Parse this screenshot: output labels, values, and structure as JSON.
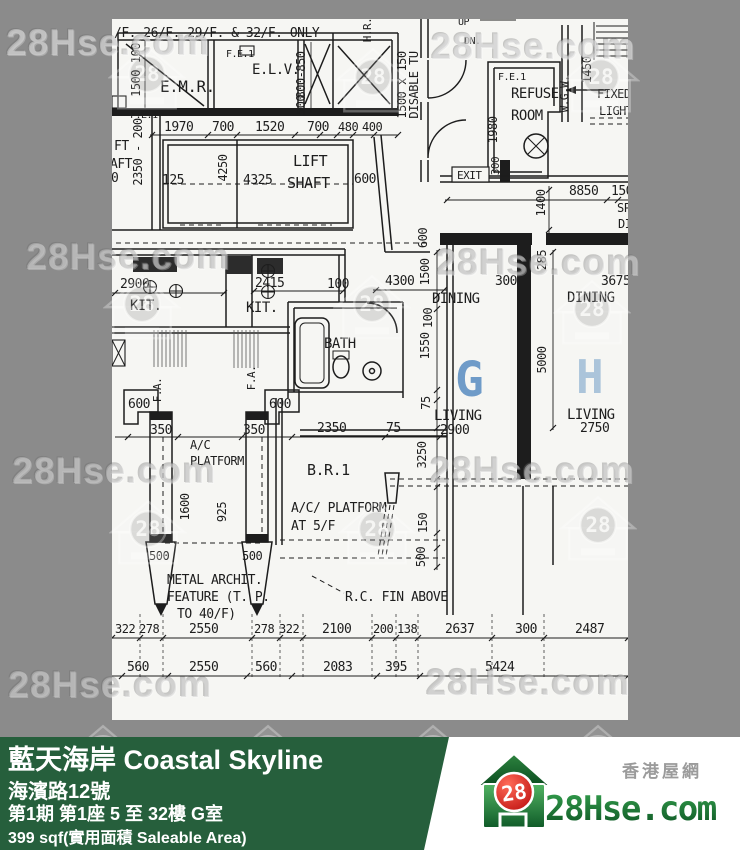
{
  "colors": {
    "page_bg": "#8b8b8b",
    "paper": "#f6f6f3",
    "ink": "#1d1d1d",
    "footer_green": "#265f3c",
    "brand_green_dark": "#0d5524",
    "brand_green_light": "#3fa351",
    "brand_red": "#c40f0f",
    "unit_g_color": "#6f9bc8",
    "unit_h_color": "#abc4da"
  },
  "watermark": {
    "text": "28Hse.com",
    "logo_number": "28"
  },
  "footer": {
    "title": "藍天海岸 Coastal Skyline",
    "address": "海濱路12號",
    "unit_info": "第1期 第1座 5 至 32樓 G室",
    "area": "399 sqf(實用面積 Saleable Area)"
  },
  "brand": {
    "site_cn": "香港屋網",
    "site_name": "28Hse.com",
    "logo_number": "28"
  },
  "plan": {
    "labels": [
      {
        "t": "/F. 26/F. 29/F. & 32/F. ONLY",
        "x": 114,
        "y": 37,
        "s": 13
      },
      {
        "t": "E.M.R.",
        "x": 160,
        "y": 92,
        "s": 16
      },
      {
        "t": "F.E.1",
        "x": 130,
        "y": 118,
        "s": 10
      },
      {
        "t": "F.E.1",
        "x": 226,
        "y": 57,
        "s": 10
      },
      {
        "t": "E.L.V.",
        "x": 252,
        "y": 74,
        "s": 14
      },
      {
        "t": "UP",
        "x": 458,
        "y": 25,
        "s": 10
      },
      {
        "t": "DN.",
        "x": 464,
        "y": 44,
        "s": 10
      },
      {
        "t": "F.E.1",
        "x": 498,
        "y": 80,
        "s": 10
      },
      {
        "t": "REFUSE",
        "x": 511,
        "y": 98,
        "s": 14
      },
      {
        "t": "ROOM",
        "x": 511,
        "y": 120,
        "s": 14
      },
      {
        "t": "FIXED",
        "x": 597,
        "y": 98,
        "s": 12
      },
      {
        "t": "LIGHT",
        "x": 599,
        "y": 115,
        "s": 12
      },
      {
        "t": "EXIT",
        "x": 457,
        "y": 179,
        "s": 11
      },
      {
        "t": "8850",
        "x": 569,
        "y": 195,
        "s": 13
      },
      {
        "t": "150",
        "x": 611,
        "y": 195,
        "s": 13
      },
      {
        "t": "SP",
        "x": 617,
        "y": 212,
        "s": 12
      },
      {
        "t": "DI",
        "x": 618,
        "y": 228,
        "s": 12
      },
      {
        "t": "FT",
        "x": 114,
        "y": 150,
        "s": 13
      },
      {
        "t": "AFT",
        "x": 110,
        "y": 168,
        "s": 13
      },
      {
        "t": "0",
        "x": 111,
        "y": 182,
        "s": 13
      },
      {
        "t": "1970",
        "x": 164,
        "y": 131,
        "s": 13
      },
      {
        "t": "700",
        "x": 212,
        "y": 131,
        "s": 13
      },
      {
        "t": "1520",
        "x": 255,
        "y": 131,
        "s": 13
      },
      {
        "t": "700",
        "x": 307,
        "y": 131,
        "s": 13
      },
      {
        "t": "480",
        "x": 338,
        "y": 131,
        "s": 12
      },
      {
        "t": "400",
        "x": 362,
        "y": 131,
        "s": 12
      },
      {
        "t": "LIFT",
        "x": 293,
        "y": 166,
        "s": 15
      },
      {
        "t": "SHAFT",
        "x": 287,
        "y": 188,
        "s": 15
      },
      {
        "t": "125",
        "x": 162,
        "y": 184,
        "s": 13
      },
      {
        "t": "4325",
        "x": 243,
        "y": 184,
        "s": 13
      },
      {
        "t": "600",
        "x": 354,
        "y": 183,
        "s": 13
      },
      {
        "t": "2900",
        "x": 120,
        "y": 288,
        "s": 13
      },
      {
        "t": "KIT.",
        "x": 130,
        "y": 310,
        "s": 14
      },
      {
        "t": "2415",
        "x": 255,
        "y": 287,
        "s": 13
      },
      {
        "t": "KIT.",
        "x": 246,
        "y": 312,
        "s": 14
      },
      {
        "t": "100",
        "x": 327,
        "y": 288,
        "s": 13
      },
      {
        "t": "BATH",
        "x": 324,
        "y": 348,
        "s": 14
      },
      {
        "t": "600",
        "x": 128,
        "y": 408,
        "s": 13
      },
      {
        "t": "600",
        "x": 269,
        "y": 408,
        "s": 13
      },
      {
        "t": "350",
        "x": 150,
        "y": 434,
        "s": 13
      },
      {
        "t": "350",
        "x": 243,
        "y": 434,
        "s": 13
      },
      {
        "t": "2350",
        "x": 317,
        "y": 432,
        "s": 13
      },
      {
        "t": "75",
        "x": 386,
        "y": 432,
        "s": 13
      },
      {
        "t": "A/C",
        "x": 190,
        "y": 449,
        "s": 12
      },
      {
        "t": "PLATFORM",
        "x": 190,
        "y": 465,
        "s": 12
      },
      {
        "t": "B.R.1",
        "x": 307,
        "y": 475,
        "s": 15
      },
      {
        "t": "A/C/ PLATFORM",
        "x": 291,
        "y": 512,
        "s": 13
      },
      {
        "t": "AT 5/F",
        "x": 291,
        "y": 530,
        "s": 13
      },
      {
        "t": "500",
        "x": 149,
        "y": 560,
        "s": 12
      },
      {
        "t": "500",
        "x": 242,
        "y": 560,
        "s": 12
      },
      {
        "t": "METAL ARCHIT.",
        "x": 167,
        "y": 584,
        "s": 13
      },
      {
        "t": "FEATURE (T. P.",
        "x": 167,
        "y": 601,
        "s": 13
      },
      {
        "t": "TO 40/F)",
        "x": 177,
        "y": 618,
        "s": 13
      },
      {
        "t": "R.C. FIN ABOVE",
        "x": 345,
        "y": 601,
        "s": 13
      },
      {
        "t": "4300",
        "x": 385,
        "y": 285,
        "s": 13
      },
      {
        "t": "300",
        "x": 495,
        "y": 285,
        "s": 13
      },
      {
        "t": "3675",
        "x": 601,
        "y": 285,
        "s": 13
      },
      {
        "t": "DINING",
        "x": 432,
        "y": 303,
        "s": 14
      },
      {
        "t": "DINING",
        "x": 567,
        "y": 302,
        "s": 14
      },
      {
        "t": "G",
        "x": 455,
        "y": 396,
        "s": 48,
        "c": "#6f9bc8",
        "b": 1
      },
      {
        "t": "H",
        "x": 576,
        "y": 393,
        "s": 46,
        "c": "#abc4da",
        "b": 1
      },
      {
        "t": "LIVING",
        "x": 434,
        "y": 420,
        "s": 14
      },
      {
        "t": "2900",
        "x": 440,
        "y": 434,
        "s": 13
      },
      {
        "t": "LIVING",
        "x": 567,
        "y": 419,
        "s": 14
      },
      {
        "t": "2750",
        "x": 580,
        "y": 432,
        "s": 13
      },
      {
        "t": "322",
        "x": 115,
        "y": 633,
        "s": 12
      },
      {
        "t": "278",
        "x": 139,
        "y": 633,
        "s": 12
      },
      {
        "t": "2550",
        "x": 189,
        "y": 633,
        "s": 13
      },
      {
        "t": "278",
        "x": 254,
        "y": 633,
        "s": 12
      },
      {
        "t": "322",
        "x": 279,
        "y": 633,
        "s": 12
      },
      {
        "t": "2100",
        "x": 322,
        "y": 633,
        "s": 13
      },
      {
        "t": "200",
        "x": 373,
        "y": 633,
        "s": 12
      },
      {
        "t": "138",
        "x": 397,
        "y": 633,
        "s": 12
      },
      {
        "t": "2637",
        "x": 445,
        "y": 633,
        "s": 13
      },
      {
        "t": "300",
        "x": 515,
        "y": 633,
        "s": 13
      },
      {
        "t": "2487",
        "x": 575,
        "y": 633,
        "s": 13
      },
      {
        "t": "560",
        "x": 127,
        "y": 671,
        "s": 13
      },
      {
        "t": "2550",
        "x": 189,
        "y": 671,
        "s": 13
      },
      {
        "t": "560",
        "x": 255,
        "y": 671,
        "s": 13
      },
      {
        "t": "2083",
        "x": 323,
        "y": 671,
        "s": 13
      },
      {
        "t": "395",
        "x": 385,
        "y": 671,
        "s": 13
      },
      {
        "t": "5424",
        "x": 485,
        "y": 671,
        "s": 13
      },
      {
        "t": "1500 100",
        "x": 140,
        "y": 70,
        "s": 12,
        "v": 1
      },
      {
        "t": "2350 - 200",
        "x": 142,
        "y": 152,
        "s": 12,
        "v": 1
      },
      {
        "t": "800-850",
        "x": 305,
        "y": 75,
        "s": 12,
        "v": 1
      },
      {
        "t": "500",
        "x": 305,
        "y": 105,
        "s": 12,
        "v": 1
      },
      {
        "t": "H.R.",
        "x": 371,
        "y": 30,
        "s": 11,
        "v": 1
      },
      {
        "t": "1500 x 150",
        "x": 406,
        "y": 85,
        "s": 12,
        "v": 1
      },
      {
        "t": "DISABLE TU",
        "x": 418,
        "y": 85,
        "s": 12,
        "v": 1
      },
      {
        "t": "1980",
        "x": 497,
        "y": 130,
        "s": 12,
        "v": 1
      },
      {
        "t": "300",
        "x": 499,
        "y": 166,
        "s": 11,
        "v": 1
      },
      {
        "t": "W.G.W.",
        "x": 568,
        "y": 94,
        "s": 11,
        "v": 1
      },
      {
        "t": "1450",
        "x": 591,
        "y": 70,
        "s": 12,
        "v": 1
      },
      {
        "t": "1400",
        "x": 545,
        "y": 203,
        "s": 12,
        "v": 1
      },
      {
        "t": "600",
        "x": 427,
        "y": 238,
        "s": 12,
        "v": 1
      },
      {
        "t": "285",
        "x": 546,
        "y": 260,
        "s": 12,
        "v": 1
      },
      {
        "t": "1500",
        "x": 429,
        "y": 272,
        "s": 12,
        "v": 1
      },
      {
        "t": "100",
        "x": 432,
        "y": 318,
        "s": 12,
        "v": 1
      },
      {
        "t": "1550",
        "x": 429,
        "y": 346,
        "s": 12,
        "v": 1
      },
      {
        "t": "5000",
        "x": 546,
        "y": 360,
        "s": 12,
        "v": 1
      },
      {
        "t": "75",
        "x": 430,
        "y": 403,
        "s": 12,
        "v": 1
      },
      {
        "t": "4250",
        "x": 227,
        "y": 168,
        "s": 12,
        "v": 1
      },
      {
        "t": "3250",
        "x": 426,
        "y": 455,
        "s": 12,
        "v": 1
      },
      {
        "t": "1600",
        "x": 189,
        "y": 507,
        "s": 12,
        "v": 1
      },
      {
        "t": "925",
        "x": 226,
        "y": 512,
        "s": 12,
        "v": 1
      },
      {
        "t": "150",
        "x": 427,
        "y": 523,
        "s": 12,
        "v": 1
      },
      {
        "t": "500",
        "x": 425,
        "y": 557,
        "s": 12,
        "v": 1
      },
      {
        "t": "F.A.",
        "x": 161,
        "y": 390,
        "s": 11,
        "v": 1
      },
      {
        "t": "F.A.",
        "x": 255,
        "y": 378,
        "s": 11,
        "v": 1
      }
    ]
  }
}
